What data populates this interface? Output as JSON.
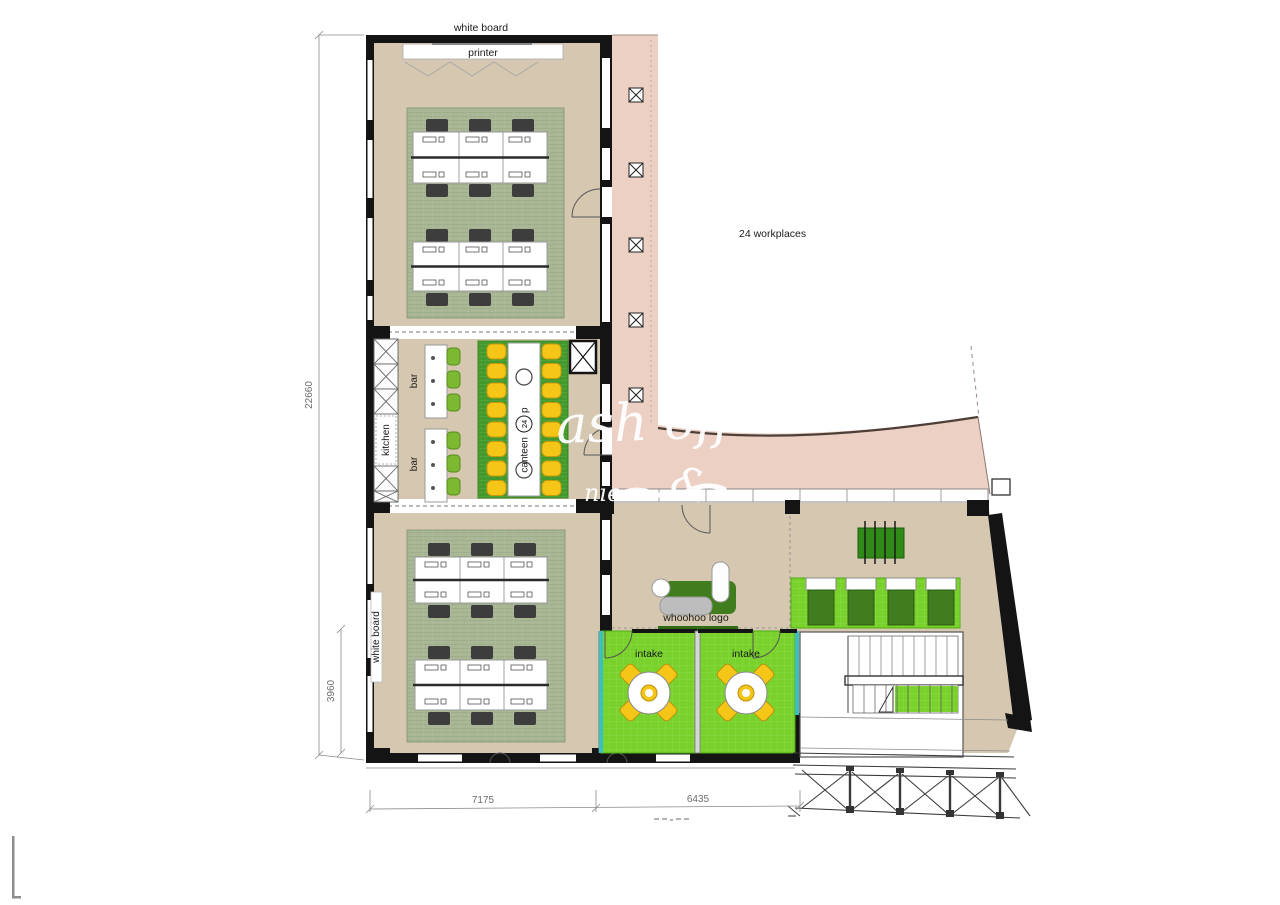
{
  "plan": {
    "title": "office floor plan",
    "labels": {
      "white_board_top": "white board",
      "printer": "printer",
      "kitchen": "kitchen",
      "bar_upper": "bar",
      "bar_lower": "bar",
      "canteen_word": "canteen",
      "canteen_capacity": "24",
      "canteen_suffix": "p",
      "workplaces_note": "24 workplaces",
      "whoohoo": "whoohoo logo",
      "intake_left": "intake",
      "intake_right": "intake",
      "white_board_left": "white board"
    },
    "dimensions": {
      "total_height": "22660",
      "lower_room_height": "3960",
      "bottom_left_width": "7175",
      "bottom_right_width": "6435"
    },
    "watermark": {
      "line1": "ash off",
      "flourish": "&",
      "fragment": "nie"
    },
    "colors": {
      "wall": "#141414",
      "floor": "#d5c7b0",
      "carpet": "#a9b795",
      "carpet_line": "#93a383",
      "canteen_rug": "#459a2e",
      "canteen_rug_line": "#5fb348",
      "bright_green": "#79d12c",
      "bright_green_line": "#90de4e",
      "pink": "#ecd0c4",
      "yellow_chair": "#f5c518",
      "gray_chair": "#3d3d3d",
      "bar_chair_green": "#7cb832",
      "sofa_green": "#3f7d1e",
      "teal": "#3ac0c0",
      "dim_gray": "#777777"
    }
  }
}
